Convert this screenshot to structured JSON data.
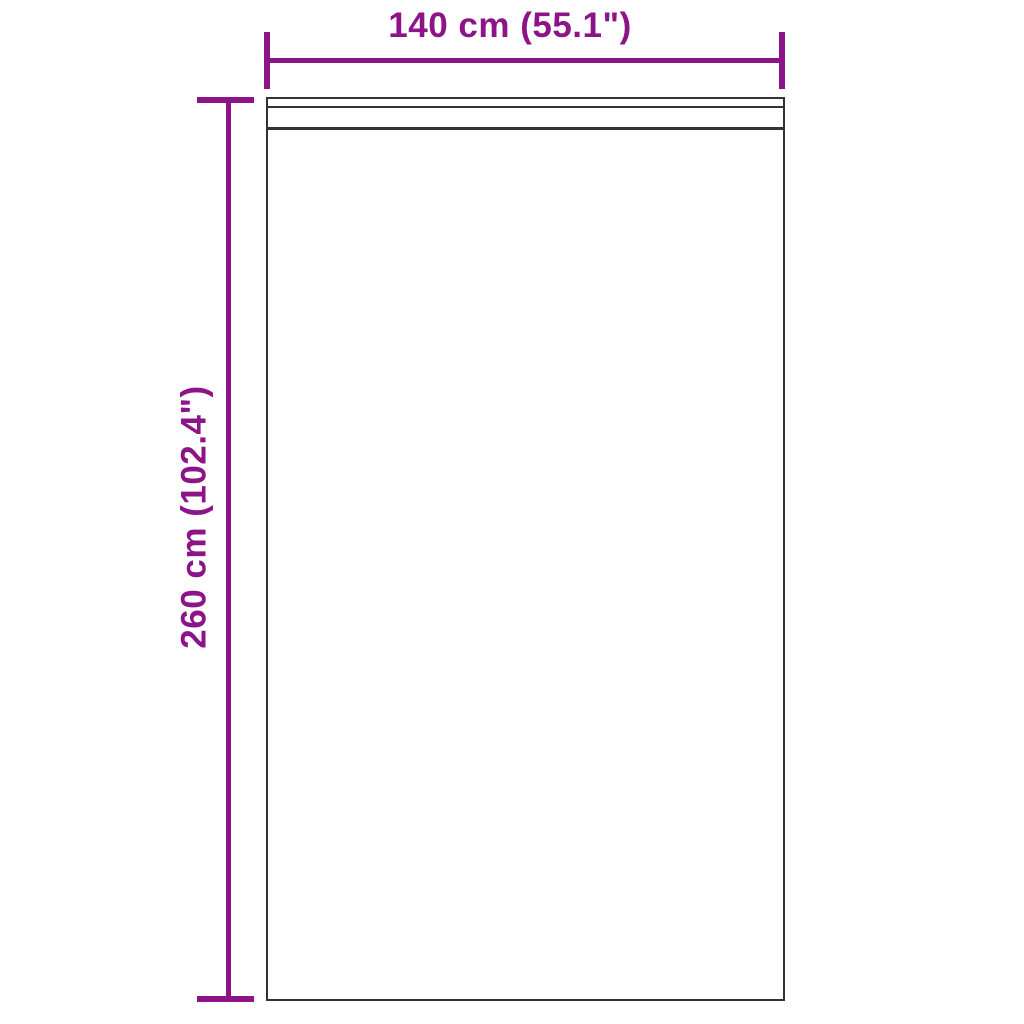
{
  "dimensions": {
    "width": {
      "label": "140 cm (55.1\")"
    },
    "height": {
      "label": "260 cm (102.4\")"
    }
  },
  "colors": {
    "dimension_annotation": "#8D1389",
    "product_outline": "#333333",
    "background": "#FFFFFF"
  }
}
